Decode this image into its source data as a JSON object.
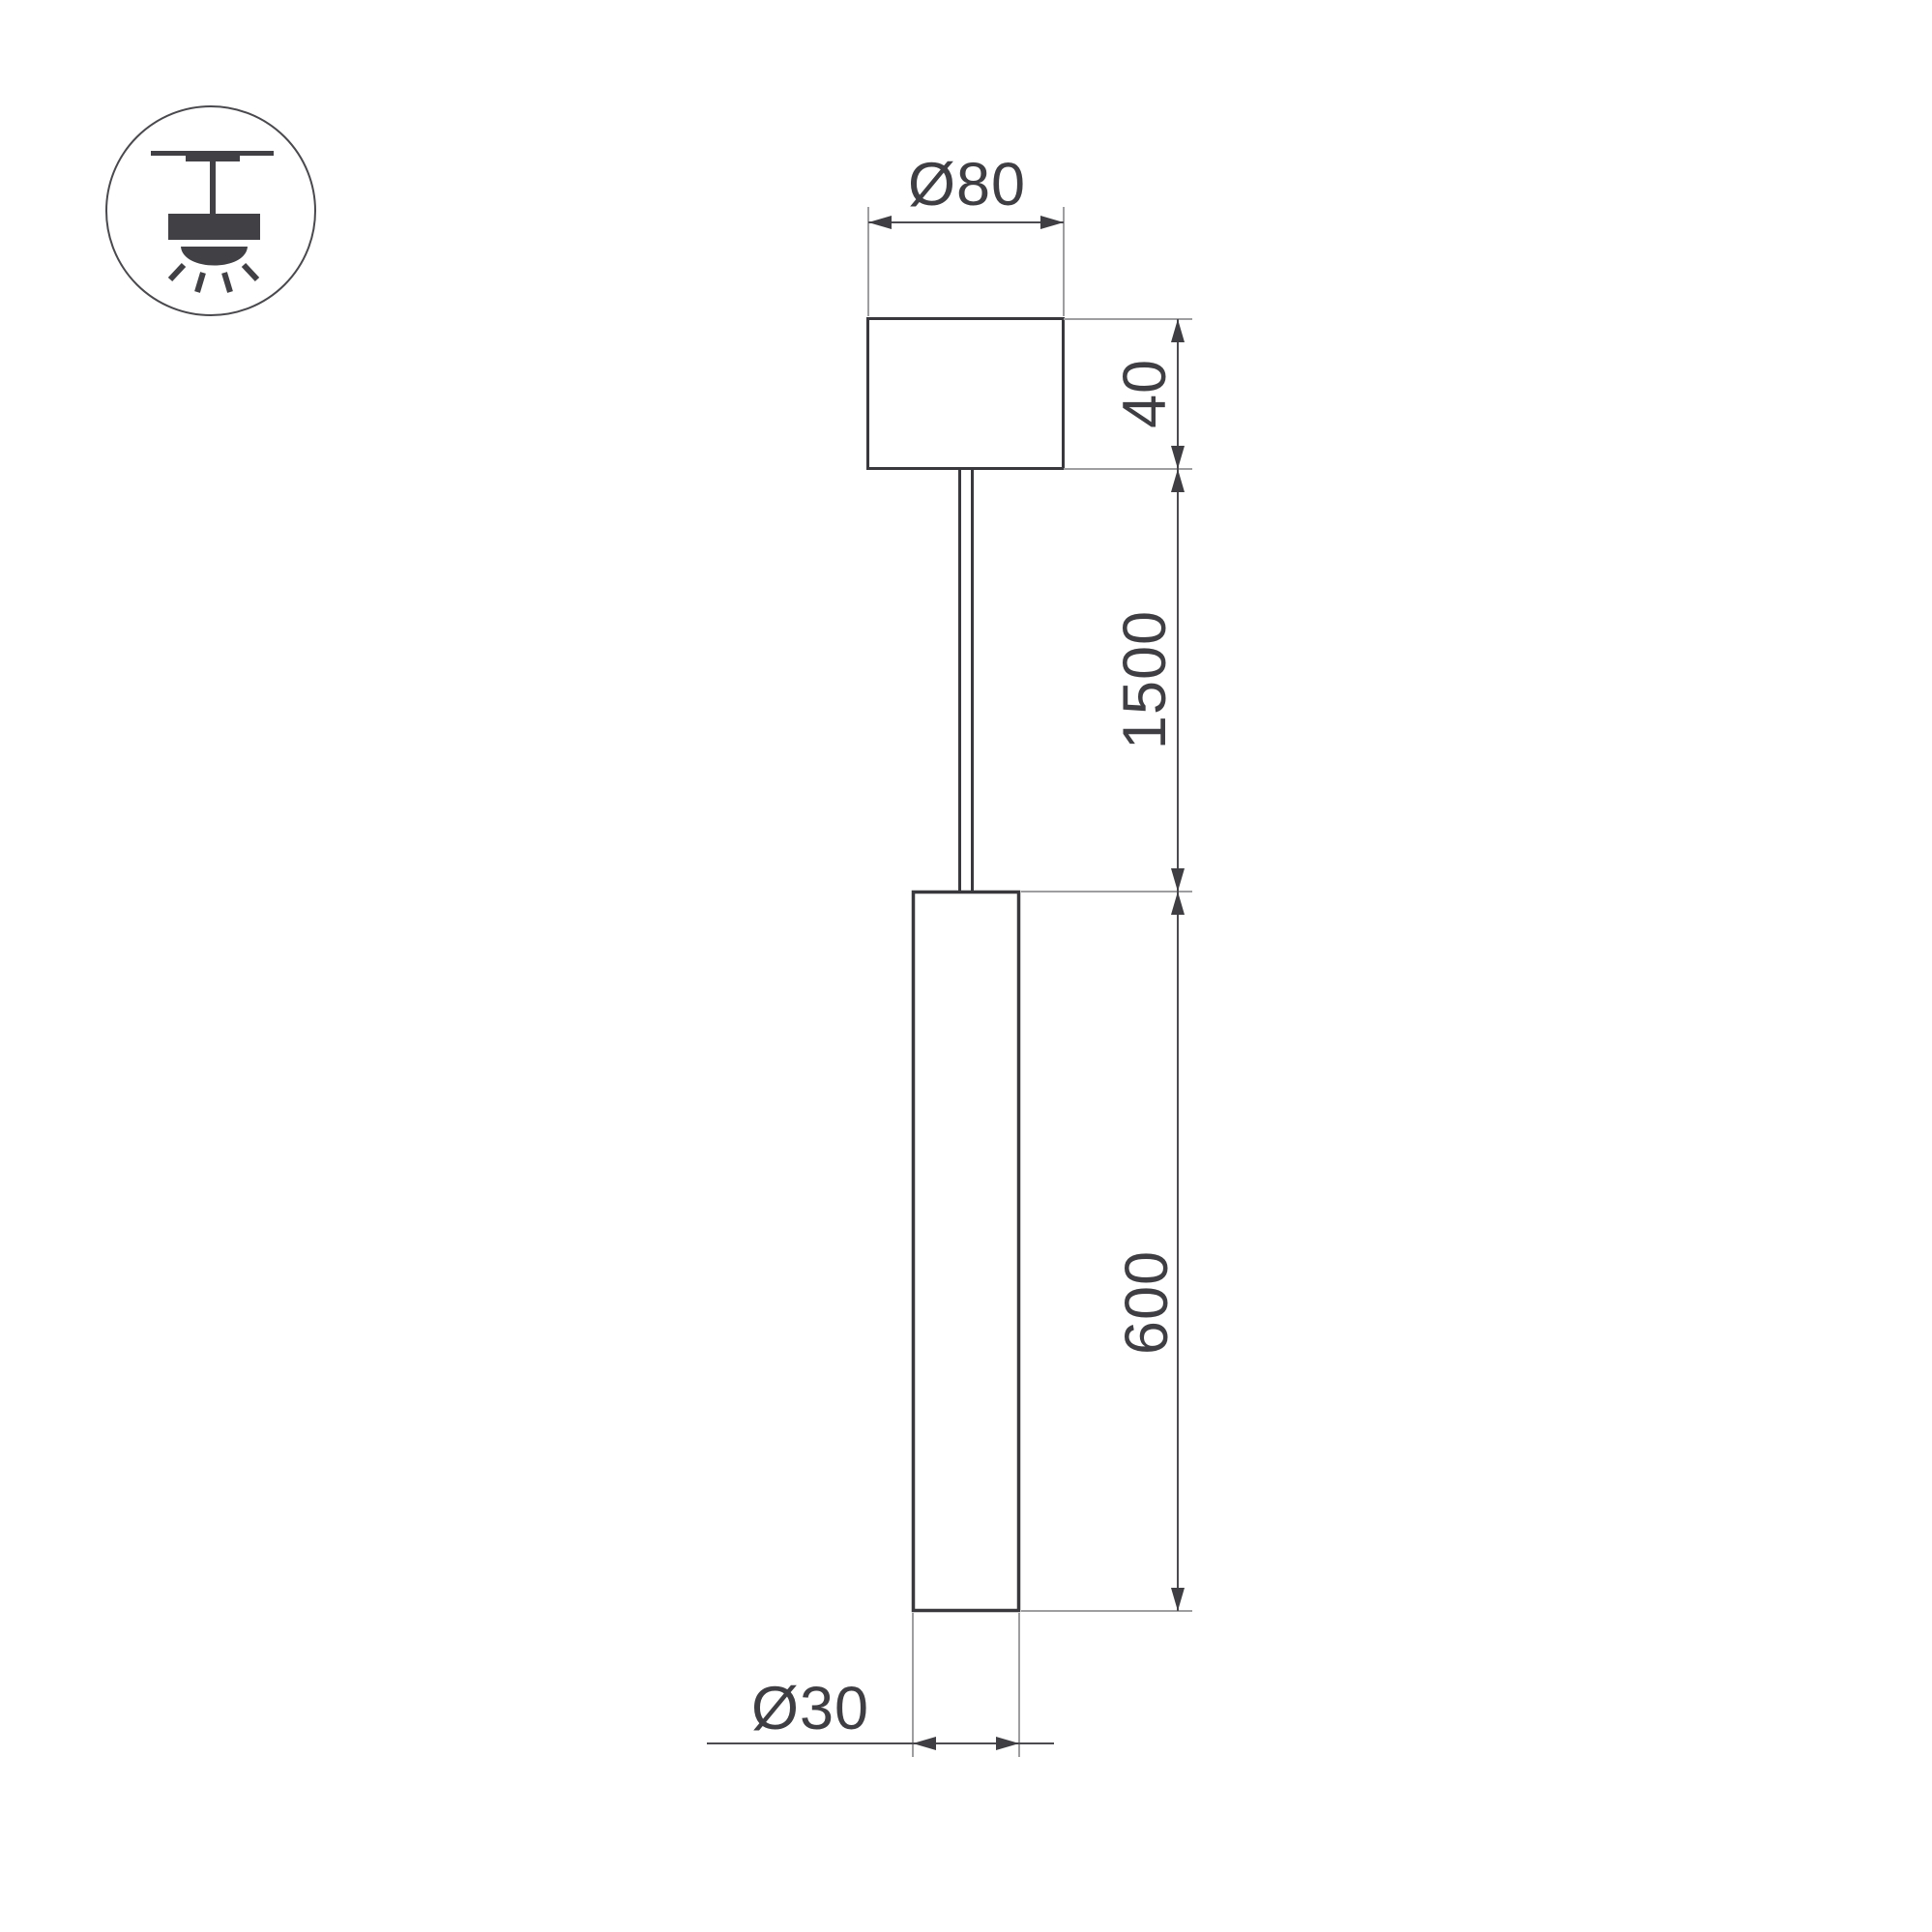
{
  "drawing": {
    "title": "pendant-lamp-dimension-drawing",
    "background": "#ffffff",
    "colors": {
      "object_stroke": "#39393d",
      "dimension_line": "#4c4c50",
      "extension_line": "#9e9ea0",
      "text_and_arrows": "#3f3f43",
      "icon": "#414145"
    }
  },
  "icon": {
    "name": "ceiling-pendant-light-icon"
  },
  "dimensions": {
    "canopy_diameter": {
      "label": "Ø80"
    },
    "canopy_height": {
      "label": "40"
    },
    "suspension_length": {
      "label": "1500"
    },
    "tube_length": {
      "label": "600"
    },
    "tube_diameter": {
      "label": "Ø30"
    }
  }
}
